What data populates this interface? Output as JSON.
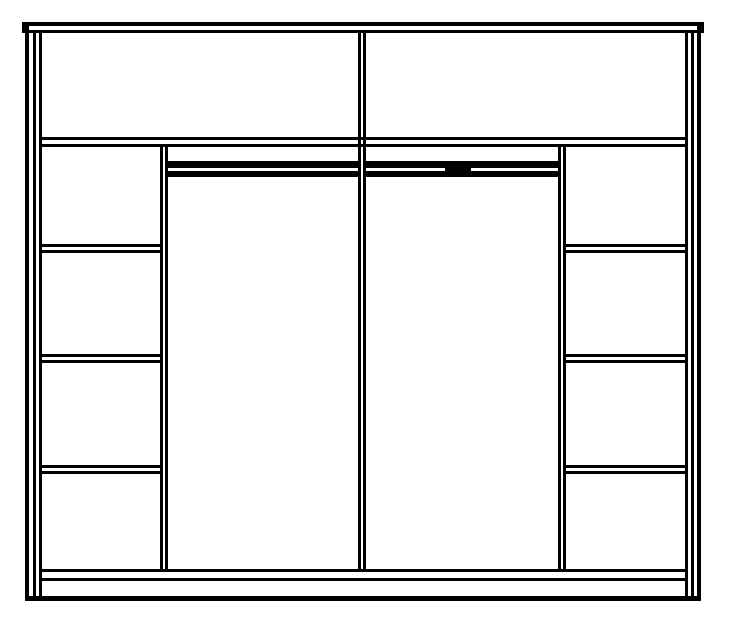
{
  "diagram": {
    "semantic": "wardrobe-interior-elevation",
    "canvas": {
      "width": 740,
      "height": 622
    },
    "colors": {
      "background": "#ffffff",
      "line": "#000000"
    },
    "counts": {
      "top_shelf_cells": 2,
      "left_column_cells": 4,
      "right_column_cells": 4,
      "hanging_sections": 2,
      "hanging_rails": 2
    },
    "elements": [
      {
        "name": "top-board",
        "kind": "board",
        "x": 22,
        "y": 22,
        "w": 682,
        "h": 11
      },
      {
        "name": "outer-frame",
        "kind": "frame",
        "x": 25,
        "y": 26,
        "w": 676,
        "h": 575
      },
      {
        "name": "left-side-panel",
        "kind": "vpanel",
        "x": 33,
        "y": 31,
        "w": 9,
        "h": 568
      },
      {
        "name": "right-side-panel",
        "kind": "vpanel",
        "x": 685,
        "y": 31,
        "w": 9,
        "h": 568
      },
      {
        "name": "top-shelf-panel",
        "kind": "hpanel",
        "x": 42,
        "y": 137,
        "w": 643,
        "h": 10
      },
      {
        "name": "center-partition",
        "kind": "vpanel",
        "x": 358,
        "y": 31,
        "w": 8,
        "h": 538
      },
      {
        "name": "left-column-partition",
        "kind": "vpanel",
        "x": 160,
        "y": 144,
        "w": 8,
        "h": 425
      },
      {
        "name": "right-column-partition",
        "kind": "vpanel",
        "x": 558,
        "y": 144,
        "w": 8,
        "h": 425
      },
      {
        "name": "base-panel",
        "kind": "hpanel",
        "x": 42,
        "y": 569,
        "w": 643,
        "h": 12
      },
      {
        "name": "left-shelf-1",
        "kind": "hpanel",
        "x": 42,
        "y": 244,
        "w": 118,
        "h": 9
      },
      {
        "name": "left-shelf-2",
        "kind": "hpanel",
        "x": 42,
        "y": 354,
        "w": 118,
        "h": 9
      },
      {
        "name": "left-shelf-3",
        "kind": "hpanel",
        "x": 42,
        "y": 465,
        "w": 118,
        "h": 9
      },
      {
        "name": "right-shelf-1",
        "kind": "hpanel",
        "x": 566,
        "y": 244,
        "w": 119,
        "h": 9
      },
      {
        "name": "right-shelf-2",
        "kind": "hpanel",
        "x": 566,
        "y": 354,
        "w": 119,
        "h": 9
      },
      {
        "name": "right-shelf-3",
        "kind": "hpanel",
        "x": 566,
        "y": 465,
        "w": 119,
        "h": 9
      },
      {
        "name": "hanging-rail-left",
        "kind": "rail",
        "x": 168,
        "y": 161,
        "w": 190,
        "h": 16
      },
      {
        "name": "hanging-rail-right",
        "kind": "rail",
        "x": 366,
        "y": 161,
        "w": 192,
        "h": 16
      },
      {
        "name": "rail-bracket",
        "kind": "solid",
        "x": 445,
        "y": 162,
        "w": 26,
        "h": 13
      }
    ]
  }
}
